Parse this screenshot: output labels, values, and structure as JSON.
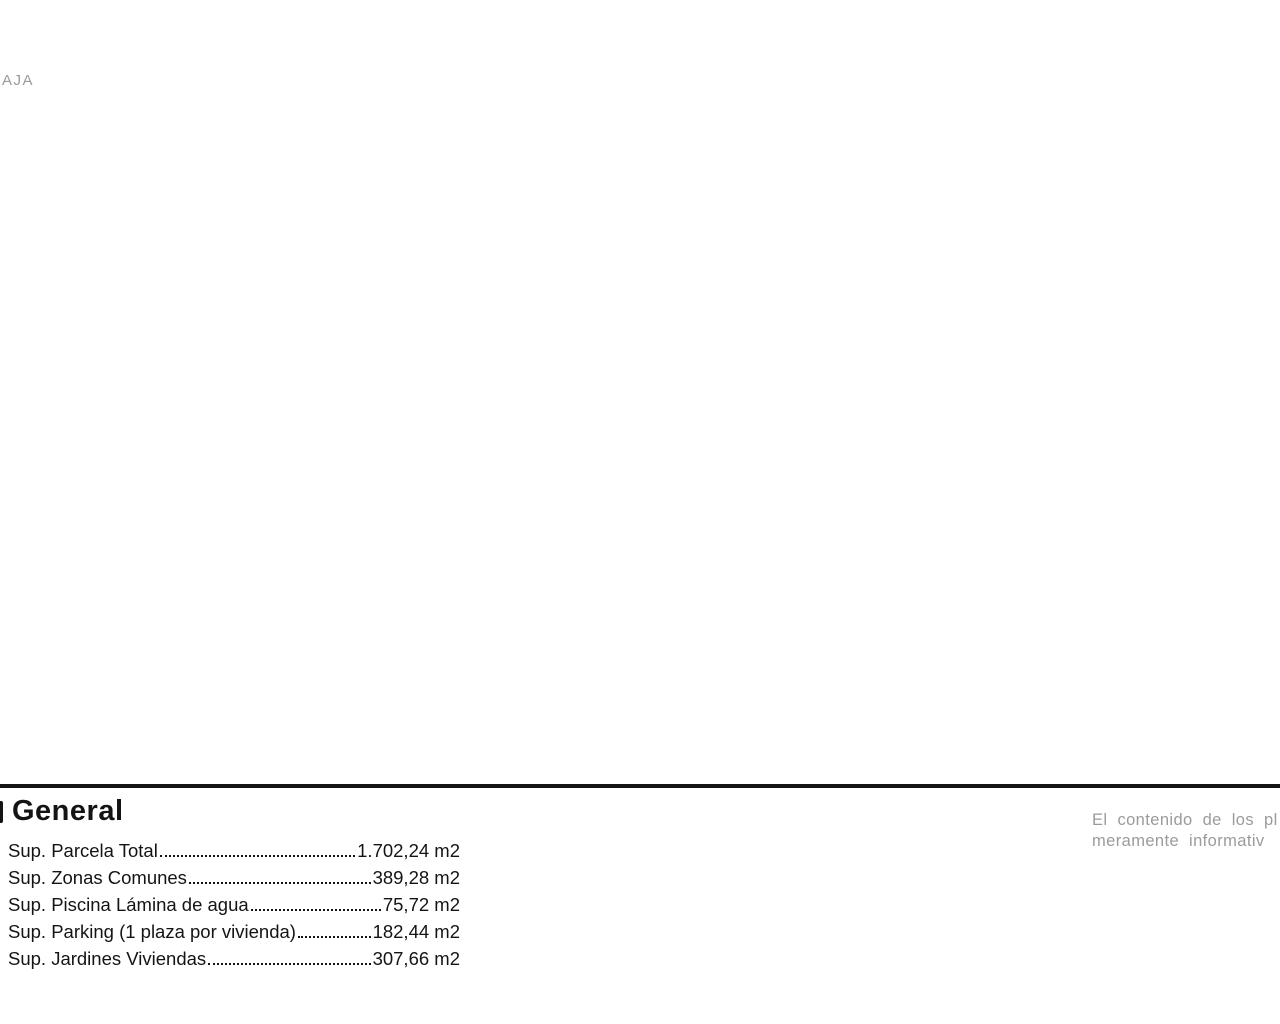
{
  "plan": {
    "corner_label": "AJA",
    "unit_numbers_left": [
      {
        "n": "1",
        "x": 122
      },
      {
        "n": "2",
        "x": 283
      },
      {
        "n": "3",
        "x": 407
      }
    ],
    "unit_numbers_right": [
      {
        "n": "4",
        "x": 505
      },
      {
        "n": "5",
        "x": 752
      },
      {
        "n": "6",
        "x": 788
      },
      {
        "n": "7",
        "x": 973
      },
      {
        "n": "8",
        "x": 1133
      }
    ],
    "rooms": {
      "bedroom": "Dormitorio",
      "bath": "Baño",
      "living": "Salón-comedor-cocina",
      "porch": "Porche",
      "garden": "Jardín",
      "spa": "SPA",
      "gym": "Zona Gym",
      "shed_line1": "Caseta Motor",
      "shed_line2": "Piscina"
    },
    "cota": "cota +0,15",
    "parking_spaces": 16
  },
  "footer": {
    "legend_title": "General",
    "rows": [
      {
        "label": "Sup. Parcela Total ",
        "value": "1.702,24 m2"
      },
      {
        "label": "Sup. Zonas Comunes ",
        "value": "389,28 m2"
      },
      {
        "label": "Sup. Piscina Lámina de agua",
        "value": "75,72 m2"
      },
      {
        "label": "Sup. Parking (1 plaza por vivienda)",
        "value": "182,44 m2"
      },
      {
        "label": "Sup. Jardines Viviendas",
        "value": "307,66 m2"
      }
    ],
    "disclaimer_line1": "El contenido de los pl",
    "disclaimer_line2": "meramente informativ"
  },
  "colors": {
    "wall": "#161616",
    "lawn": "#c9ecb6",
    "lawn_hatch": "#9bdb8b",
    "palm": "#2db32d",
    "pool_top": "#4a7fc0",
    "pool_bottom": "#c7e0f3",
    "pool_steps": "#274f80",
    "gray_text": "#9b9b9b"
  }
}
